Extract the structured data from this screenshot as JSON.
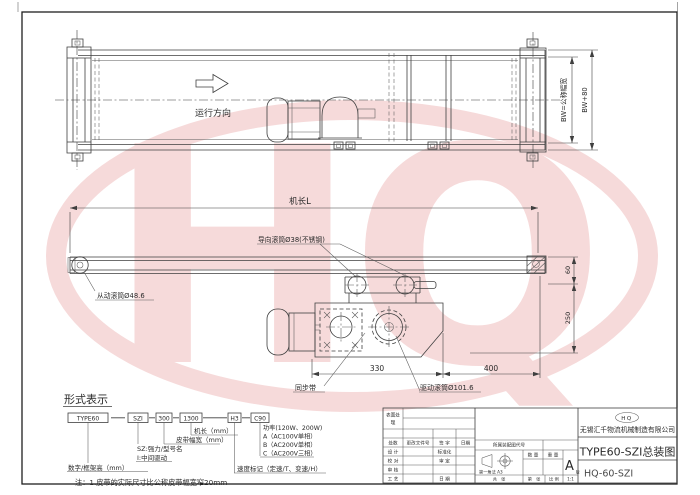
{
  "watermark": {
    "letters": "HQ"
  },
  "colors": {
    "line": "#3f3f3f",
    "watermark_pink": "#efbcbc",
    "paper": "#ffffff"
  },
  "top_view": {
    "direction_label": "运行方向",
    "dim_belt_width": "BW=公称幅宽",
    "dim_overall_width": "BW+80"
  },
  "side_view": {
    "dim_length": "机长L",
    "guide_roller_label": "导向滚筒Ø38(不锈钢)",
    "driven_roller_label": "从动滚筒Ø48.6",
    "sync_belt_label": "同步带",
    "drive_roller_label": "驱动滚筒Ø101.6",
    "dim_330": "330",
    "dim_400": "400",
    "dim_60": "60",
    "dim_250": "250"
  },
  "format_section": {
    "heading": "形式表示",
    "code_boxes": [
      "TYPE60",
      "SZI",
      "300",
      "1300",
      "H3",
      "C90"
    ],
    "labels": {
      "machine_length": "机长（mm）",
      "belt_width": "皮带幅宽（mm）",
      "sz": "SZ:强力/型号名",
      "i_drive": "I:中间驱动",
      "frame_height": "数字/框架高（mm）",
      "speed_mark": "速度标记（定速/T、变速/H）",
      "power": "功率(120W、200W)",
      "power_a": "A（AC100V单相）",
      "power_b": "B（AC200V单相）",
      "power_c": "C（AC200V三相）"
    },
    "note": "注：1.皮带的实际尺寸比公称皮带幅宽窄20mm"
  },
  "title_block": {
    "surface_line1": "表面处",
    "surface_line2": "理",
    "rev_count": "处数",
    "change_doc_no": "更改文件号",
    "signature": "签 字",
    "date": "日期",
    "design": "设 计",
    "standardization": "标准化",
    "check": "校 对",
    "approve": "审 定",
    "review": "审 核",
    "process": "工 艺",
    "date2": "日 期",
    "assembly_code": "所属装配图代号",
    "projection": "第一角法  A3",
    "quantity": "数 量",
    "weight": "重 量",
    "revision": "A",
    "revision_sub": "版",
    "sheet_total": "共　张",
    "sheet_no": "第　张",
    "scale_label": "比 例",
    "scale_value": "1:1",
    "logo": "HQ",
    "company": "无锡汇千物流机械制造有限公司",
    "drawing_title": "TYPE60-SZI总装图",
    "drawing_no": "HQ-60-SZI"
  }
}
